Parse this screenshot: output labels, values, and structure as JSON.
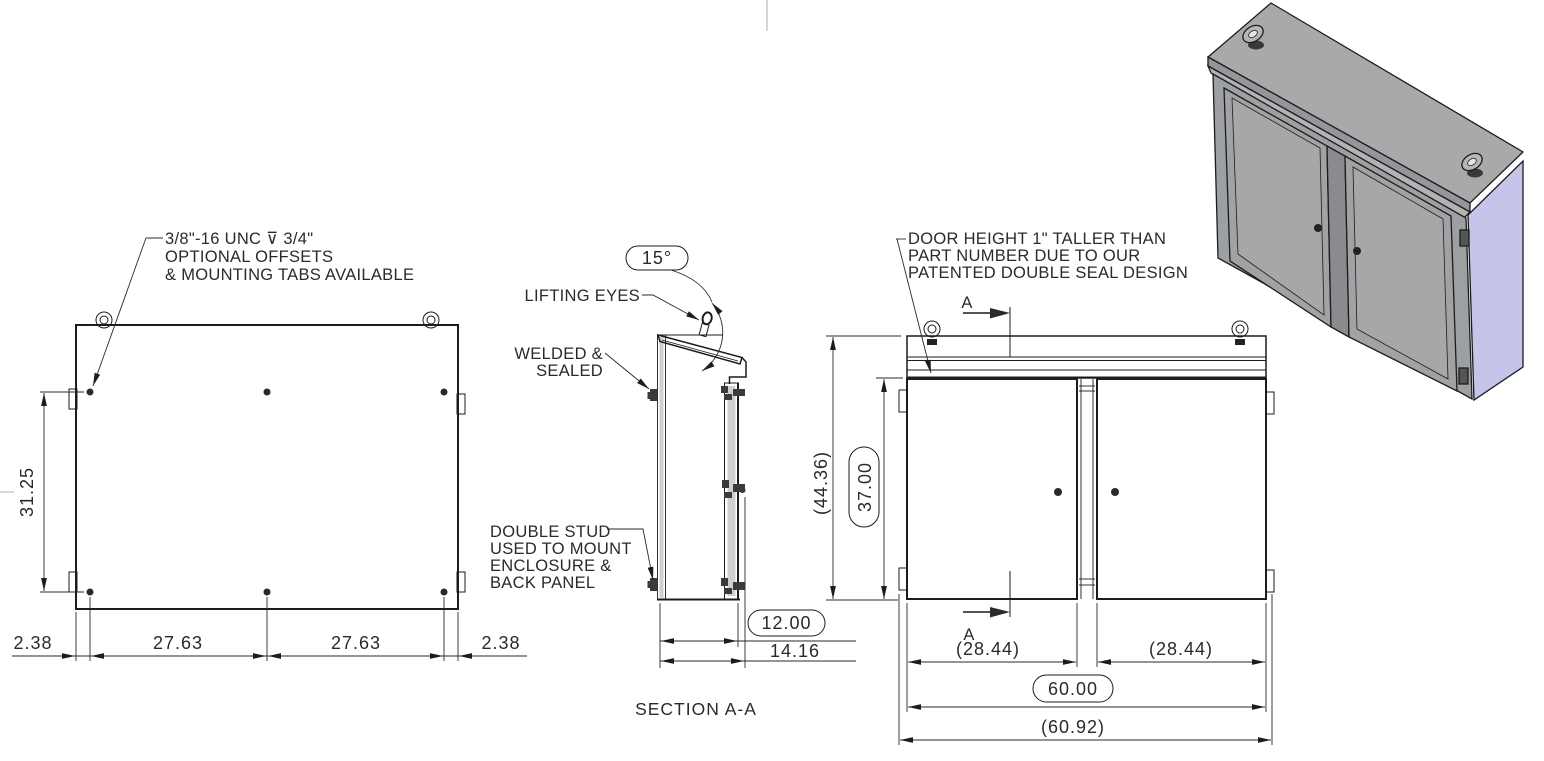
{
  "drawing": {
    "mount_note": {
      "line1": "3/8\"-16 UNC ⊽ 3/4\"",
      "line2": "OPTIONAL OFFSETS",
      "line3": "& MOUNTING TABS AVAILABLE"
    },
    "rear_view": {
      "dim_stud_vertical": "31.25",
      "dim_left_offset": "2.38",
      "dim_stud_span_1": "27.63",
      "dim_stud_span_2": "27.63",
      "dim_right_offset": "2.38"
    },
    "section_view": {
      "roof_angle": "15°",
      "label_lifting_eyes": "LIFTING EYES",
      "label_welded_1": "WELDED &",
      "label_welded_2": "SEALED",
      "label_stud_1": "DOUBLE STUD",
      "label_stud_2": "USED TO MOUNT",
      "label_stud_3": "ENCLOSURE &",
      "label_stud_4": "BACK PANEL",
      "dim_depth_basic": "12.00",
      "dim_depth_overall": "14.16",
      "title": "SECTION A-A"
    },
    "front_view": {
      "door_note_1": "DOOR HEIGHT 1\" TALLER THAN",
      "door_note_2": "PART NUMBER DUE TO OUR",
      "door_note_3": "PATENTED DOUBLE SEAL DESIGN",
      "section_arrow_top": "A",
      "section_arrow_bottom": "A",
      "dim_height_overall": "(44.36)",
      "dim_height_basic": "37.00",
      "dim_door_left": "(28.44)",
      "dim_door_right": "(28.44)",
      "dim_width_basic": "60.00",
      "dim_width_overall": "(60.92)"
    },
    "colors": {
      "line": "#1c1c1c",
      "roof_gray": "#a9a9ab",
      "front_gray": "#9da0a3",
      "door_gray": "#a2a2a4",
      "side_lavender": "#c4c5e9"
    }
  }
}
